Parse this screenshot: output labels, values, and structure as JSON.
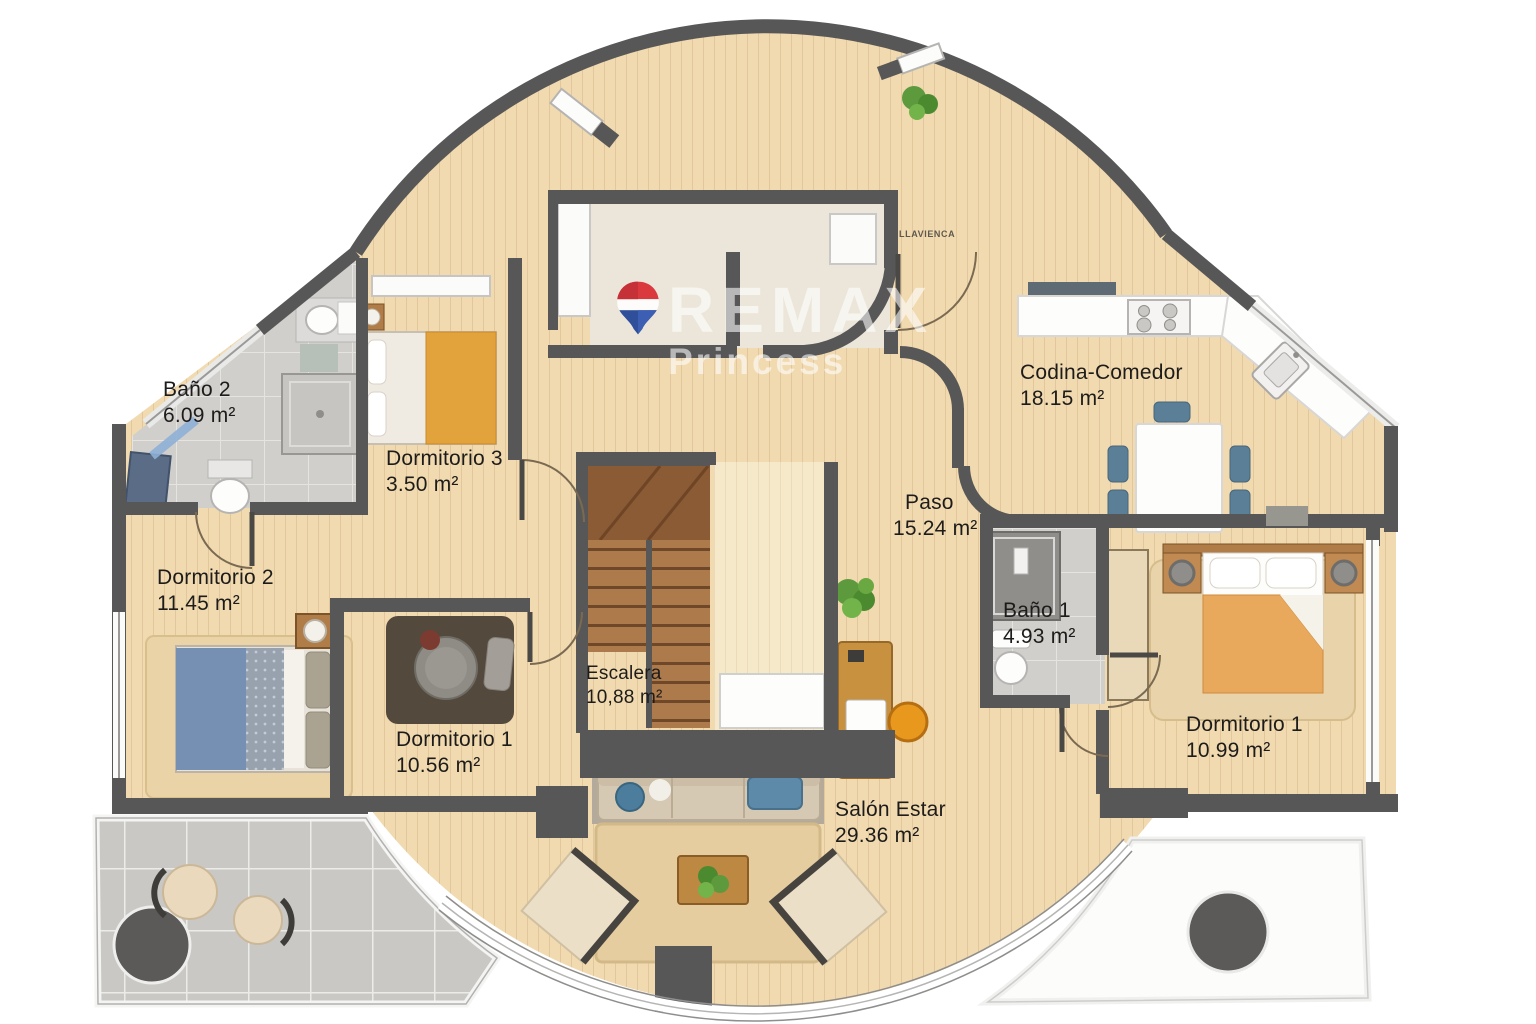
{
  "watermark": {
    "brand": "REMAX",
    "sub": "Princess"
  },
  "stamp": "LLAVIENCA",
  "rooms": [
    {
      "id": "bano-2",
      "name": "Baño 2",
      "area": "6.09 m²"
    },
    {
      "id": "dormitorio-3",
      "name": "Dormitorio 3",
      "area": "3.50 m²"
    },
    {
      "id": "dormitorio-2",
      "name": "Dormitorio 2",
      "area": "11.45 m²"
    },
    {
      "id": "dormitorio-1-left",
      "name": "Dormitorio 1",
      "area": "10.56 m²"
    },
    {
      "id": "escalera",
      "name": "Escalera",
      "area": "10,88 m²"
    },
    {
      "id": "codina-comedor",
      "name": "Codina-Comedor",
      "area": "18.15 m²"
    },
    {
      "id": "paso",
      "name": "Paso",
      "area": "15.24 m²"
    },
    {
      "id": "bano-1",
      "name": "Baño 1",
      "area": "4.93 m²"
    },
    {
      "id": "dormitorio-1-right",
      "name": "Dormitorio 1",
      "area": "10.99 m²"
    },
    {
      "id": "salon-estar",
      "name": "Salón Estar",
      "area": "29.36 m²"
    }
  ],
  "colors": {
    "wall": "#585757",
    "wood_floor": "#f1dab0",
    "light_wood": "#f6e9c9",
    "bath_tile": "#d0cfcc",
    "terrace_tile": "#c9c8c5",
    "hall_floor": "#ece6da",
    "stair_wood": "#ad7a4c",
    "remax_red": "#d9272e",
    "remax_blue": "#1b3f94",
    "bed_orange": "#e3a33c",
    "bed_blue": "#7590b2",
    "chair_blue": "#5b7f96",
    "desk_orange": "#e8991d",
    "plant_green": "#5d9a3e"
  }
}
